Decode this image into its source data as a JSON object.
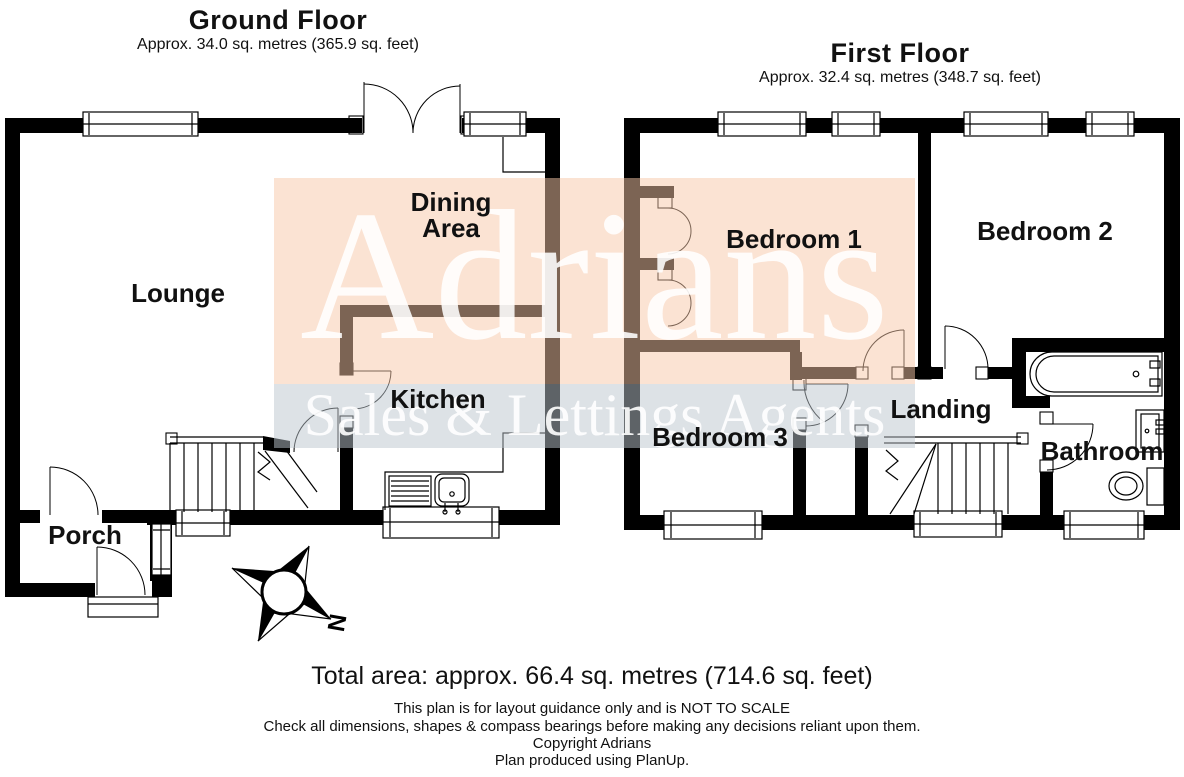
{
  "ground_floor": {
    "title": "Ground Floor",
    "area_line": "Approx. 34.0 sq. metres (365.9 sq. feet)",
    "rooms": {
      "lounge": "Lounge",
      "dining_line1": "Dining",
      "dining_line2": "Area",
      "kitchen": "Kitchen",
      "porch": "Porch"
    }
  },
  "first_floor": {
    "title": "First Floor",
    "area_line": "Approx. 32.4 sq. metres (348.7 sq. feet)",
    "rooms": {
      "bedroom1": "Bedroom 1",
      "bedroom2": "Bedroom 2",
      "bedroom3": "Bedroom 3",
      "landing": "Landing",
      "bathroom": "Bathroom"
    }
  },
  "watermark": {
    "brand": "Adrians",
    "tagline": "Sales & Lettings Agents"
  },
  "compass": {
    "north_label": "N"
  },
  "footer": {
    "total_area": "Total area: approx. 66.4 sq. metres (714.6 sq. feet)",
    "disclaimer_line1": "This plan is for layout guidance only and is NOT TO SCALE",
    "disclaimer_line2": "Check all dimensions, shapes & compass bearings before making any decisions reliant upon them.",
    "copyright_line": "Copyright Adrians",
    "produced_line": "Plan produced using PlanUp."
  },
  "colors": {
    "wall": "#000000",
    "watermark_pink": "#f7c7a7",
    "watermark_gray": "#bcc5ce"
  }
}
